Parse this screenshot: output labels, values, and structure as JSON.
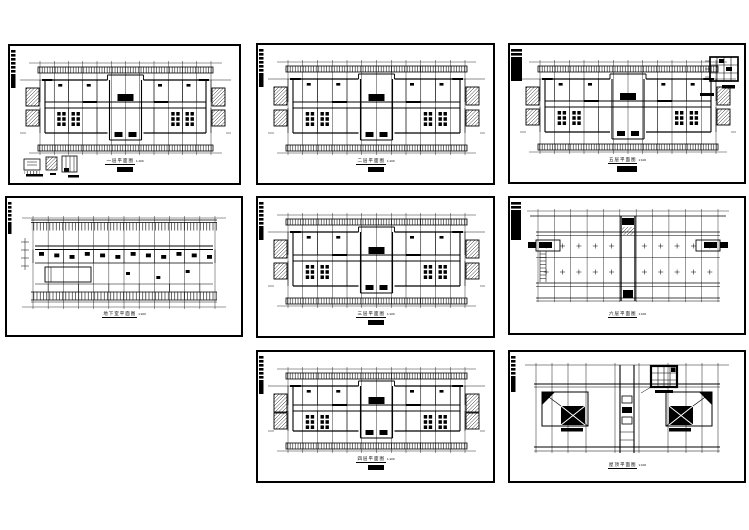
{
  "sheet": {
    "paper_color": "#ffffff",
    "ink_color": "#000000",
    "description": "eight architectural CAD floor plan drawings"
  },
  "panels": [
    {
      "name": "first-floor-plan",
      "title": "一层平面图",
      "scale": "1:100",
      "variant": "floor-legend",
      "x": 8,
      "y": 44,
      "w": 233,
      "h": 141,
      "sub": true
    },
    {
      "name": "second-floor-plan",
      "title": "二层平面图",
      "scale": "1:100",
      "variant": "floor",
      "x": 256,
      "y": 43,
      "w": 239,
      "h": 142,
      "sub": true
    },
    {
      "name": "fifth-floor-plan",
      "title": "五层平面图",
      "scale": "1:100",
      "variant": "floor-detail",
      "x": 508,
      "y": 43,
      "w": 238,
      "h": 141,
      "sub": true,
      "tab": {
        "w": 11,
        "dash": 8,
        "solid": 24
      }
    },
    {
      "name": "basement-plan",
      "title": "地下室平面图",
      "scale": "1:100",
      "variant": "basement",
      "x": 5,
      "y": 196,
      "w": 238,
      "h": 141,
      "sub": false,
      "tab": {
        "w": 3.5,
        "dash": 22,
        "solid": 10
      }
    },
    {
      "name": "third-floor-plan",
      "title": "三层平面图",
      "scale": "1:100",
      "variant": "floor",
      "x": 256,
      "y": 196,
      "w": 239,
      "h": 142,
      "sub": true
    },
    {
      "name": "sixth-floor-plan",
      "title": "六层平面图",
      "scale": "1:100",
      "variant": "grid",
      "x": 508,
      "y": 196,
      "w": 238,
      "h": 139,
      "sub": false,
      "tab": {
        "w": 10,
        "dash": 10,
        "solid": 28
      }
    },
    {
      "name": "fourth-floor-plan",
      "title": "四层平面图",
      "scale": "1:100",
      "variant": "floor",
      "x": 256,
      "y": 350,
      "w": 239,
      "h": 133,
      "sub": true
    },
    {
      "name": "roof-plan",
      "title": "屋顶平面图",
      "scale": "1:100",
      "variant": "roof",
      "x": 508,
      "y": 350,
      "w": 238,
      "h": 133,
      "sub": false,
      "tab": {
        "w": 4.5,
        "dash": 20,
        "solid": 16
      }
    }
  ]
}
